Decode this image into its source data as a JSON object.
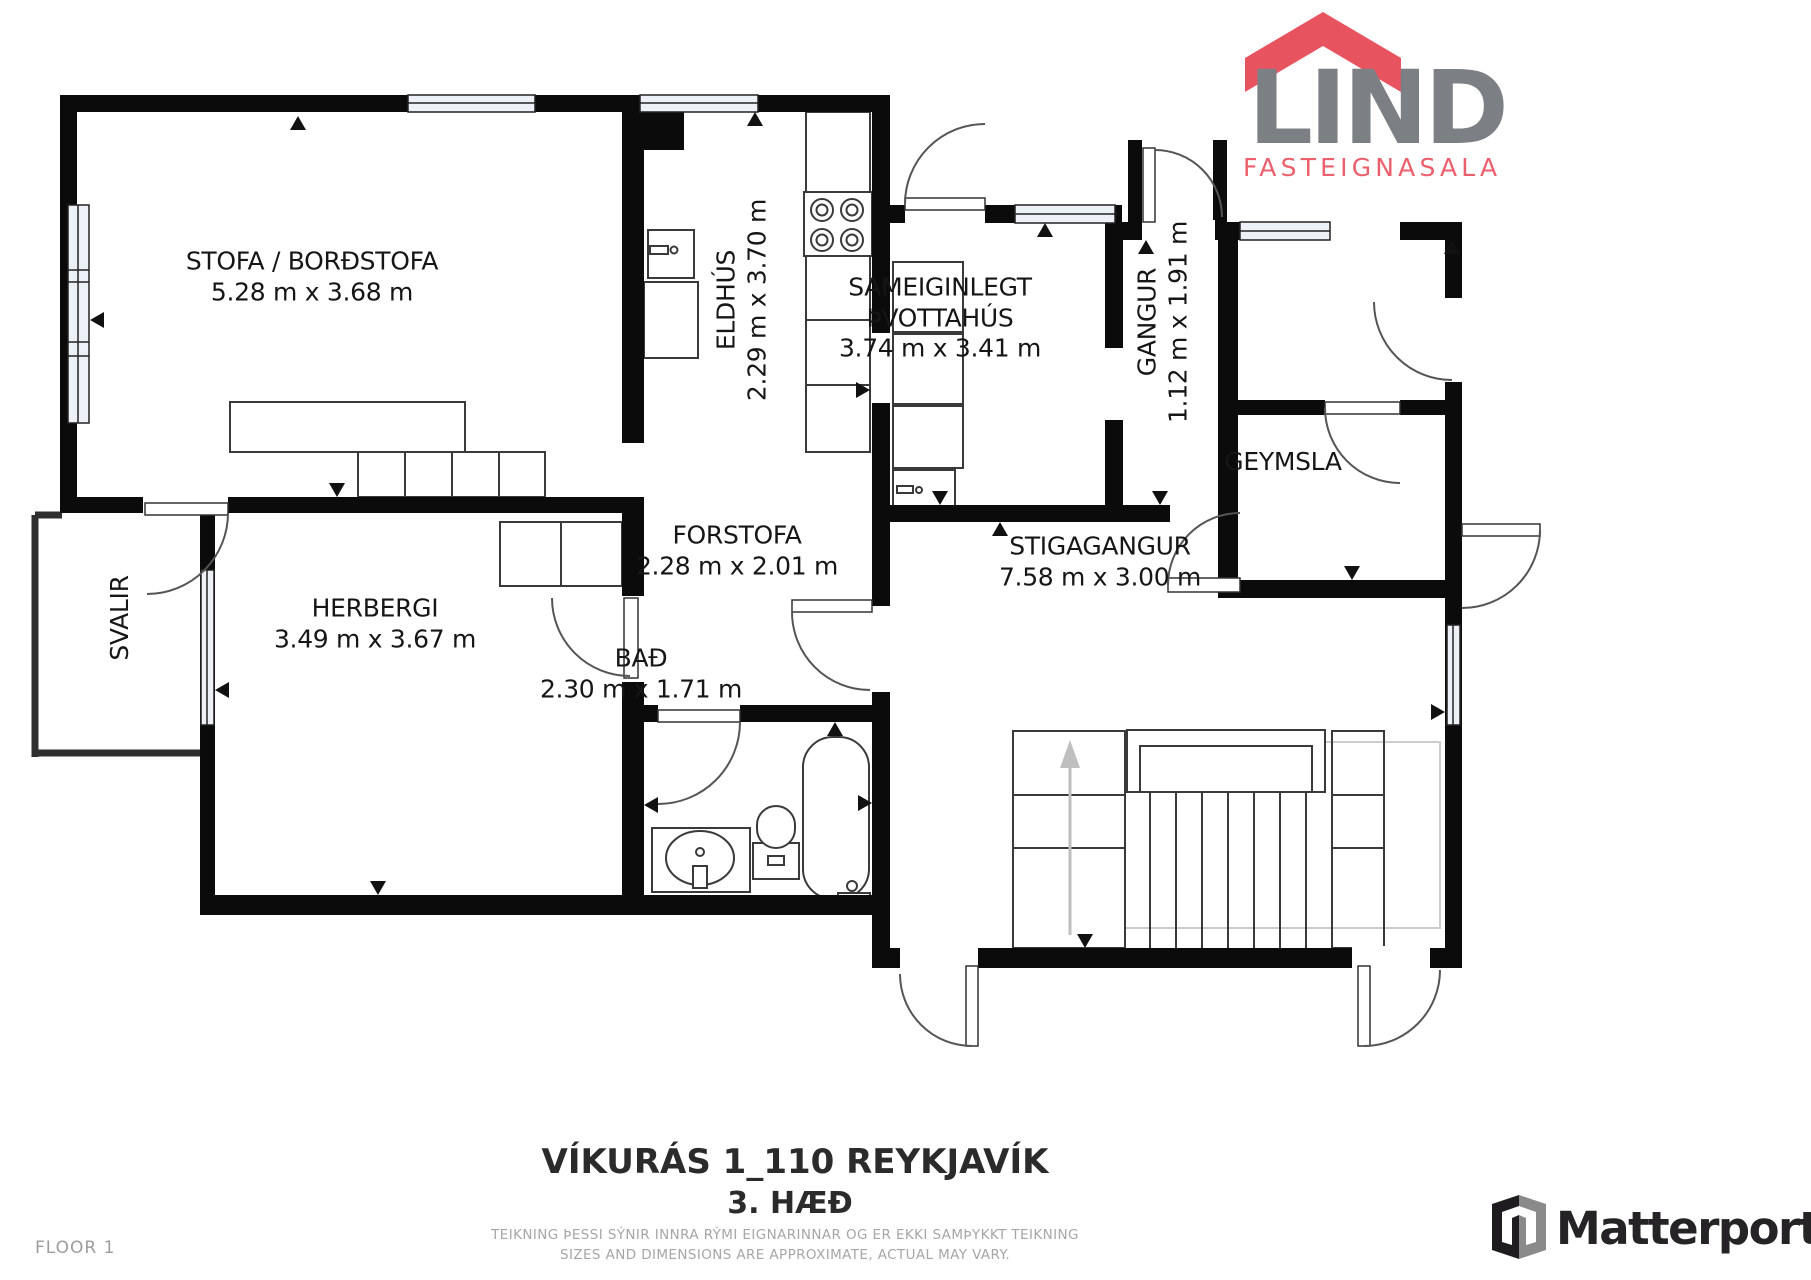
{
  "brand": {
    "name": "LIND",
    "tagline": "FASTEIGNASALA",
    "roof_color": "#e85360",
    "text_color": "#7c8085",
    "tagline_color": "#ec5f6c"
  },
  "rooms": {
    "stofa": {
      "name": "STOFA / BORÐSTOFA",
      "dims": "5.28 m x 3.68 m"
    },
    "eldhus": {
      "name": "ELDHÚS",
      "dims": "2.29 m x 3.70 m"
    },
    "thvottahus": {
      "name_line1": "SAMEIGINLEGT",
      "name_line2": "ÞVOTTAHÚS",
      "dims": "3.74 m x 3.41 m"
    },
    "gangur": {
      "name": "GANGUR",
      "dims": "1.12 m x 1.91 m"
    },
    "geymsla": {
      "name": "GEYMSLA"
    },
    "forstofa": {
      "name": "FORSTOFA",
      "dims": "2.28 m x 2.01 m"
    },
    "herbergi": {
      "name": "HERBERGI",
      "dims": "3.49 m x 3.67 m"
    },
    "svalir": {
      "name": "SVALIR"
    },
    "bad": {
      "name": "BAÐ",
      "dims": "2.30 m x 1.71 m"
    },
    "stigagangur": {
      "name": "STIGAGANGUR",
      "dims": "7.58 m x 3.00 m"
    }
  },
  "title": {
    "line1": "VÍKURÁS 1_110 REYKJAVÍK",
    "line2": "3. HÆÐ"
  },
  "disclaimer": {
    "line1": "TEIKNING ÞESSI SÝNIR INNRA RÝMI EIGNARINNAR OG ER EKKI SAMÞYKKT TEIKNING",
    "line2": "SIZES AND DIMENSIONS ARE APPROXIMATE, ACTUAL MAY VARY."
  },
  "footer": {
    "floor_label": "FLOOR 1",
    "matterport_label": "Matterport"
  }
}
